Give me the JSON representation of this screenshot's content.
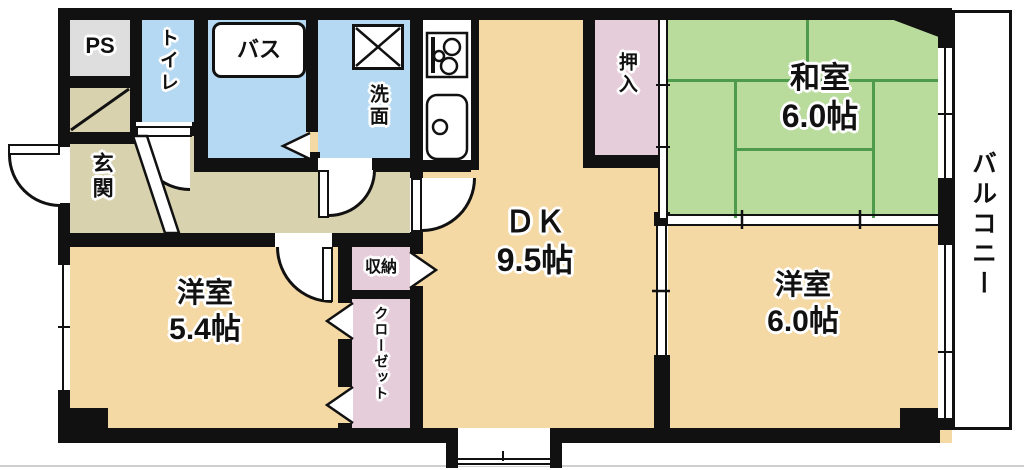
{
  "plan": {
    "title": "apartment-floor-plan",
    "rooms": {
      "dk": {
        "label": "ＤＫ",
        "size": "9.5帖"
      },
      "washitsu": {
        "label": "和室",
        "size": "6.0帖"
      },
      "yoshitsu_54": {
        "label": "洋室",
        "size": "5.4帖"
      },
      "yoshitsu_60": {
        "label": "洋室",
        "size": "6.0帖"
      },
      "genkan": {
        "label": "玄関"
      },
      "toilet": {
        "label": "トイレ"
      },
      "bath": {
        "label": "バス"
      },
      "senmen": {
        "label": "洗面"
      },
      "ps": {
        "label": "PS"
      },
      "oshiire": {
        "label": "押入"
      },
      "shuno": {
        "label": "収納"
      },
      "closet": {
        "label": "クローゼット"
      },
      "balcony": {
        "label": "バルコニー"
      }
    },
    "icons": {
      "stove": "gas-stove-icon",
      "sink": "kitchen-sink-icon",
      "washer": "washing-machine-icon",
      "doors": "door-swing-arc",
      "folding_doors": "folding-door-chevron"
    },
    "colors": {
      "wall": "#111111",
      "room_beige": "#f5d9a5",
      "hallway_olive": "#d8d2ae",
      "wet_area_blue": "#b5d9f2",
      "tatami_green": "#b9dc9d",
      "tatami_line": "#4f9b4c",
      "closet_pink": "#e6cdda",
      "ps_gray": "#dedede"
    }
  }
}
